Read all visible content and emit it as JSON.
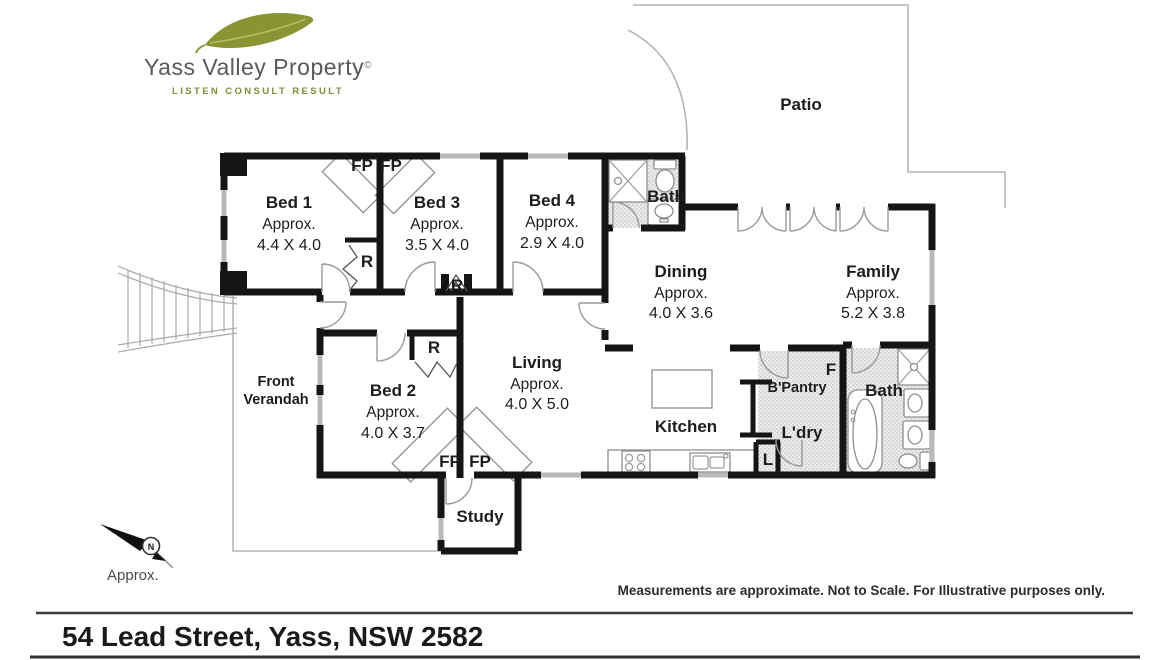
{
  "logo": {
    "name": "Yass Valley Property",
    "mark": "©",
    "tagline": "LISTEN CONSULT RESULT",
    "leaf_color": "#8a9434"
  },
  "plan": {
    "rooms": {
      "bed1": {
        "name": "Bed 1",
        "approx": "Approx.",
        "size": "4.4 X 4.0"
      },
      "bed3": {
        "name": "Bed 3",
        "approx": "Approx.",
        "size": "3.5 X 4.0"
      },
      "bed4": {
        "name": "Bed 4",
        "approx": "Approx.",
        "size": "2.9 X 4.0"
      },
      "bed2": {
        "name": "Bed 2",
        "approx": "Approx.",
        "size": "4.0 X 3.7"
      },
      "dining": {
        "name": "Dining",
        "approx": "Approx.",
        "size": "4.0 X 3.6"
      },
      "family": {
        "name": "Family",
        "approx": "Approx.",
        "size": "5.2 X 3.8"
      },
      "living": {
        "name": "Living",
        "approx": "Approx.",
        "size": "4.0 X 5.0"
      },
      "kitchen": {
        "name": "Kitchen"
      },
      "bath_front": {
        "name": "Bath"
      },
      "bath_rear": {
        "name": "Bath"
      },
      "study": {
        "name": "Study"
      },
      "patio": {
        "name": "Patio"
      },
      "verandah": {
        "line1": "Front",
        "line2": "Verandah"
      },
      "pantry": {
        "name": "B'Pantry"
      },
      "laundry": {
        "name": "L'dry"
      }
    },
    "markers": {
      "fireplace": "FP",
      "robe": "R",
      "fridge": "F",
      "linen": "L"
    },
    "wall_color": "#151515"
  },
  "compass": {
    "north": "N",
    "label": "Approx."
  },
  "footer": {
    "disclaimer": "Measurements are approximate. Not to Scale. For Illustrative purposes only.",
    "address": "54 Lead Street, Yass, NSW 2582"
  }
}
